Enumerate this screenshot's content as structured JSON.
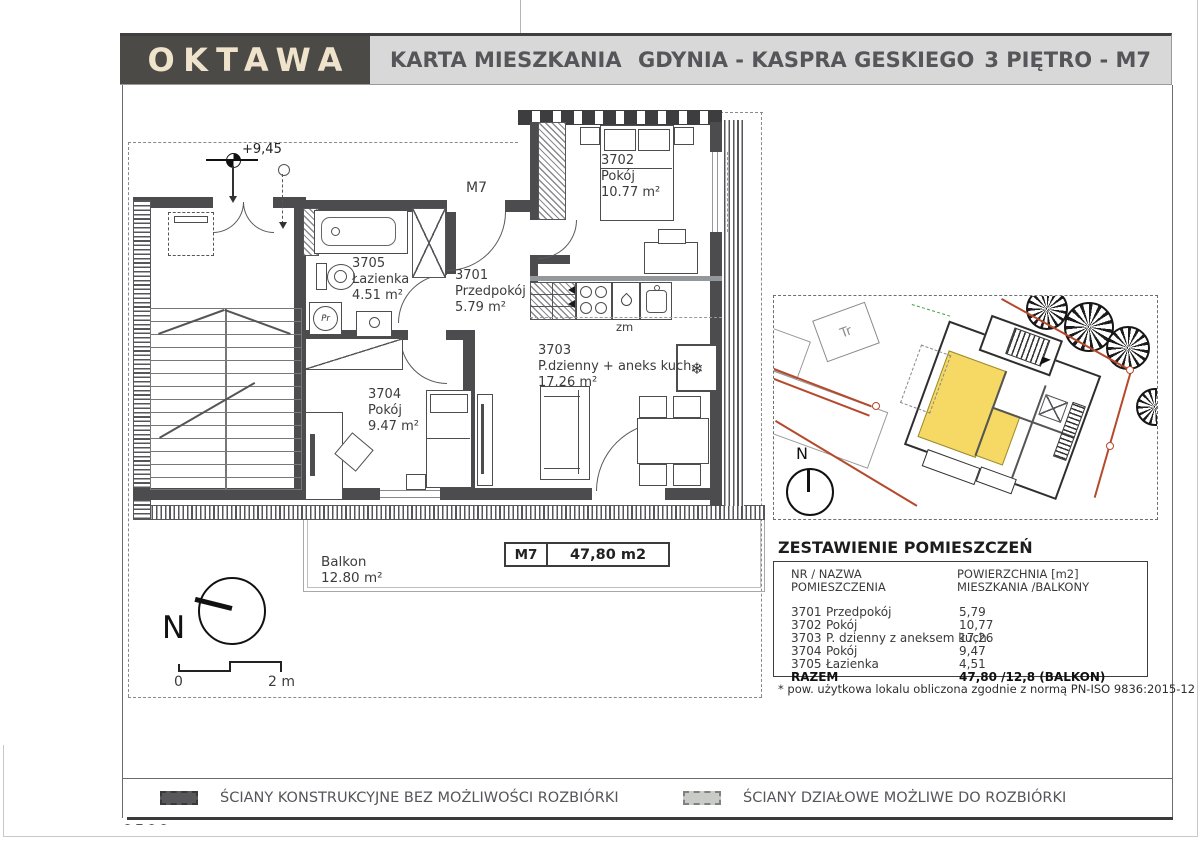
{
  "header": {
    "logo": "OKTAWA",
    "document_title": "KARTA MIESZKANIA",
    "investment": "GDYNIA - KASPRA GESKIEGO",
    "floor_unit": "3 PIĘTRO - M7"
  },
  "plan": {
    "unit_label": "M7",
    "level_marker": "+9,45",
    "rooms": [
      {
        "id": "3701",
        "name": "Przedpokój",
        "area": "5.79 m²"
      },
      {
        "id": "3702",
        "name": "Pokój",
        "area": "10.77 m²"
      },
      {
        "id": "3703",
        "name": "P.dzienny + aneks kuch.",
        "area": "17.26 m²"
      },
      {
        "id": "3704",
        "name": "Pokój",
        "area": "9.47 m²"
      },
      {
        "id": "3705",
        "name": "Łazienka",
        "area": "4.51 m²"
      }
    ],
    "balcony": {
      "name": "Balkon",
      "area": "12.80 m²"
    },
    "labels": {
      "washer": "Pr",
      "dishwasher": "zm"
    },
    "icons": {
      "fridge": "❄"
    },
    "area_box": {
      "unit": "M7",
      "area": "47,80 m2"
    },
    "compass_label": "N",
    "scale": {
      "zero": "0",
      "two": "2 m"
    }
  },
  "siteplan": {
    "transformer_label": "Tr",
    "compass_label": "N",
    "unit_highlight_color": "#f6d964",
    "boundary_color": "#b5492c"
  },
  "room_table": {
    "title": "ZESTAWIENIE POMIESZCZEŃ",
    "col1_line1": "NR / NAZWA",
    "col1_line2": "POMIESZCZENIA",
    "col2_line1": "POWIERZCHNIA [m2]",
    "col2_line2": "MIESZKANIA /BALKONY",
    "rows": [
      {
        "nr": "3701",
        "name": "Przedpokój",
        "value": "5,79"
      },
      {
        "nr": "3702",
        "name": "Pokój",
        "value": "10,77"
      },
      {
        "nr": "3703",
        "name": "P. dzienny z aneksem kuch.",
        "value": "17,26"
      },
      {
        "nr": "3704",
        "name": "Pokój",
        "value": "9,47"
      },
      {
        "nr": "3705",
        "name": "Łazienka",
        "value": "4,51"
      }
    ],
    "total_label": "RAZEM",
    "total_value": "47,80 /12,8 (BALKON)",
    "footnote": "* pow. użytkowa lokalu obliczona zgodnie z normą PN-ISO 9836:2015-12"
  },
  "legend": {
    "items": [
      {
        "label": "ŚCIANY KONSTRUKCYJNE BEZ MOŻLIWOŚCI ROZBIÓRKI",
        "swatch_color": "#58585a"
      },
      {
        "label": "ŚCIANY DZIAŁOWE MOŻLIWE DO ROZBIÓRKI",
        "swatch_color": "#c9cbc7"
      }
    ]
  },
  "footer_fragment": "0500",
  "colors": {
    "wall": "#4c4c4e",
    "header_bar": "#d8d8d8",
    "logo_bg": "#4b4a47",
    "logo_text": "#efe3cb",
    "accent_yellow": "#f6d964",
    "boundary_red": "#b5492c"
  }
}
